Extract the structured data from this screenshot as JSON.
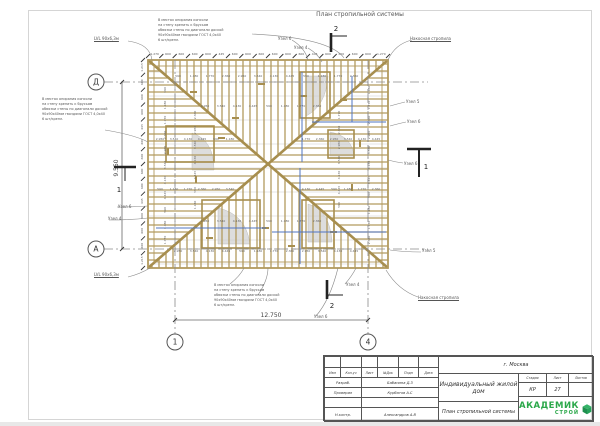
{
  "sheet": {
    "title": "План стропильной системы"
  },
  "notes": {
    "lines": [
      "В местах опирания консоли",
      "на стену крепить к брусьям",
      "обвязки стены по диагонали доской",
      "90х90х40мм гвоздями ГОСТ 4,0х40",
      "6 шт/крепл."
    ]
  },
  "axes": {
    "horizontal": [
      "Д",
      "А"
    ],
    "vertical": [
      "1",
      "4"
    ]
  },
  "dimensions": {
    "width": "12.750",
    "height": "9.550"
  },
  "sections": {
    "cut1": "1",
    "cut2": "2"
  },
  "chain_top": [
    "1.270",
    "600",
    "600",
    "600",
    "600",
    "445",
    "600",
    "600",
    "600",
    "600",
    "600",
    "600",
    "445",
    "600",
    "600",
    "600",
    "600",
    "1.270"
  ],
  "chain_left": [
    "1.215",
    "600",
    "600",
    "600",
    "445",
    "600",
    "600",
    "600",
    "600",
    "445",
    "600",
    "600",
    "600",
    "1.215"
  ],
  "rafter_dims": [
    "590",
    "1.180",
    "1.770",
    "2.360",
    "2.950",
    "3.540",
    "4.130",
    "4.445"
  ],
  "labels": [
    {
      "t": "LVL 90х6,3м",
      "x": 94,
      "y": 36,
      "u": 1
    },
    {
      "t": "Узел 6",
      "x": 278,
      "y": 36
    },
    {
      "t": "Узел 4",
      "x": 294,
      "y": 45
    },
    {
      "t": "Накосная стропила",
      "x": 410,
      "y": 36,
      "u": 1
    },
    {
      "t": "Узел 5",
      "x": 406,
      "y": 99
    },
    {
      "t": "Узел 6",
      "x": 407,
      "y": 119
    },
    {
      "t": "Узел 6",
      "x": 404,
      "y": 161
    },
    {
      "t": "Узел 5",
      "x": 422,
      "y": 248
    },
    {
      "t": "Накосная стропила",
      "x": 418,
      "y": 295,
      "u": 1
    },
    {
      "t": "Узел 6",
      "x": 118,
      "y": 204
    },
    {
      "t": "Узел 4",
      "x": 108,
      "y": 216
    },
    {
      "t": "LVL 90х6,3м",
      "x": 94,
      "y": 272,
      "u": 1
    },
    {
      "t": "Узел 4",
      "x": 346,
      "y": 282
    },
    {
      "t": "Узел 6",
      "x": 314,
      "y": 314
    }
  ],
  "titleblock": {
    "city": "г. Москва",
    "project": "Индивидуальный жилой дом",
    "sheet_title": "План стропильной системы",
    "header_cols": [
      "Изм",
      "Кол.уч",
      "Лист",
      "№Док",
      "Подп",
      "Дата"
    ],
    "rows": [
      {
        "role": "Разраб.",
        "name": "Бабанина Д.З"
      },
      {
        "role": "Проверил",
        "name": "Курбатов А.С"
      },
      {
        "role": "Н.контр.",
        "name": "Александров А.В"
      }
    ],
    "stage_label": "Стадия",
    "sheet_label": "Лист",
    "sheets_label": "Листов",
    "stage": "КР",
    "sheet_no": "27",
    "sheets_total": "",
    "logo": {
      "line1": "АКАДЕМИК",
      "line2": "СТРОЙ"
    },
    "logo_color": "#2ba84a"
  }
}
